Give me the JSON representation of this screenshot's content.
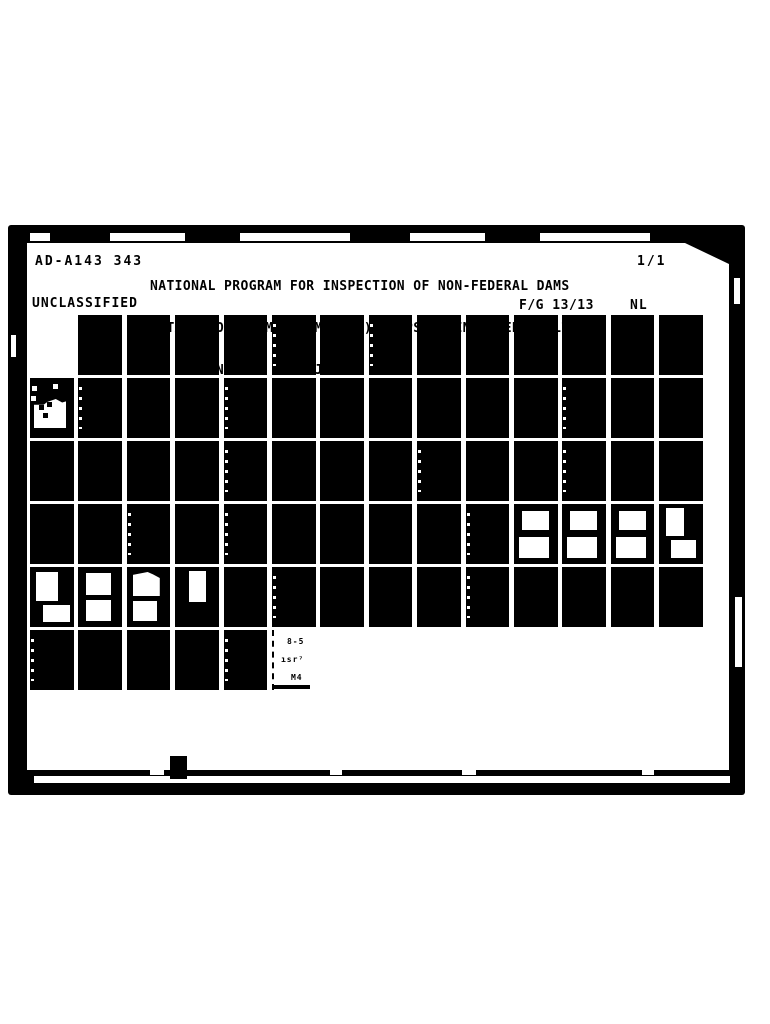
{
  "document": {
    "id_number": "AD-A143 343",
    "title_lines": [
      "NATIONAL PROGRAM FOR INSPECTION OF NON-FEDERAL DAMS",
      "POTASH POND DAM (CT M   (U) CORPS OF ENGINEERS WALTHAM",
      "MA NEW ENGLAND DIV  JAN 81"
    ],
    "sheet_count": "1/1",
    "classification": "UNCLASSIFIED",
    "fg_code": "F/G 13/13",
    "pagination_code": "NL"
  },
  "colors": {
    "ink": "#000000",
    "paper": "#ffffff"
  },
  "fiche_grid": {
    "columns": 14,
    "rows": [
      [
        ".",
        "f",
        "f",
        "f",
        "f",
        "fs",
        "f",
        "fs",
        "f",
        "f",
        "f",
        "f",
        "f",
        "f"
      ],
      [
        "ta",
        "fs",
        "f",
        "f",
        "fs",
        "f",
        "f",
        "f",
        "f",
        "f",
        "f",
        "fs",
        "f",
        "f"
      ],
      [
        "f",
        "f",
        "f",
        "f",
        "fs",
        "f",
        "f",
        "f",
        "fs",
        "f",
        "f",
        "fs",
        "f",
        "f"
      ],
      [
        "f",
        "f",
        "fs",
        "f",
        "fs",
        "f",
        "f",
        "f",
        "f",
        "fs",
        "tb",
        "tb",
        "tb",
        "tc"
      ],
      [
        "td",
        "te",
        "tf",
        "tg",
        "f",
        "fs",
        "f",
        "f",
        "f",
        "fs",
        "f",
        "f",
        "f",
        "f"
      ],
      [
        "fs",
        "f",
        "f",
        "f",
        "fs",
        "end",
        ".",
        ".",
        ".",
        ".",
        ".",
        ".",
        ".",
        "."
      ]
    ],
    "end_frame_marks": [
      "8-5",
      "ısr⁷",
      "M4"
    ]
  }
}
